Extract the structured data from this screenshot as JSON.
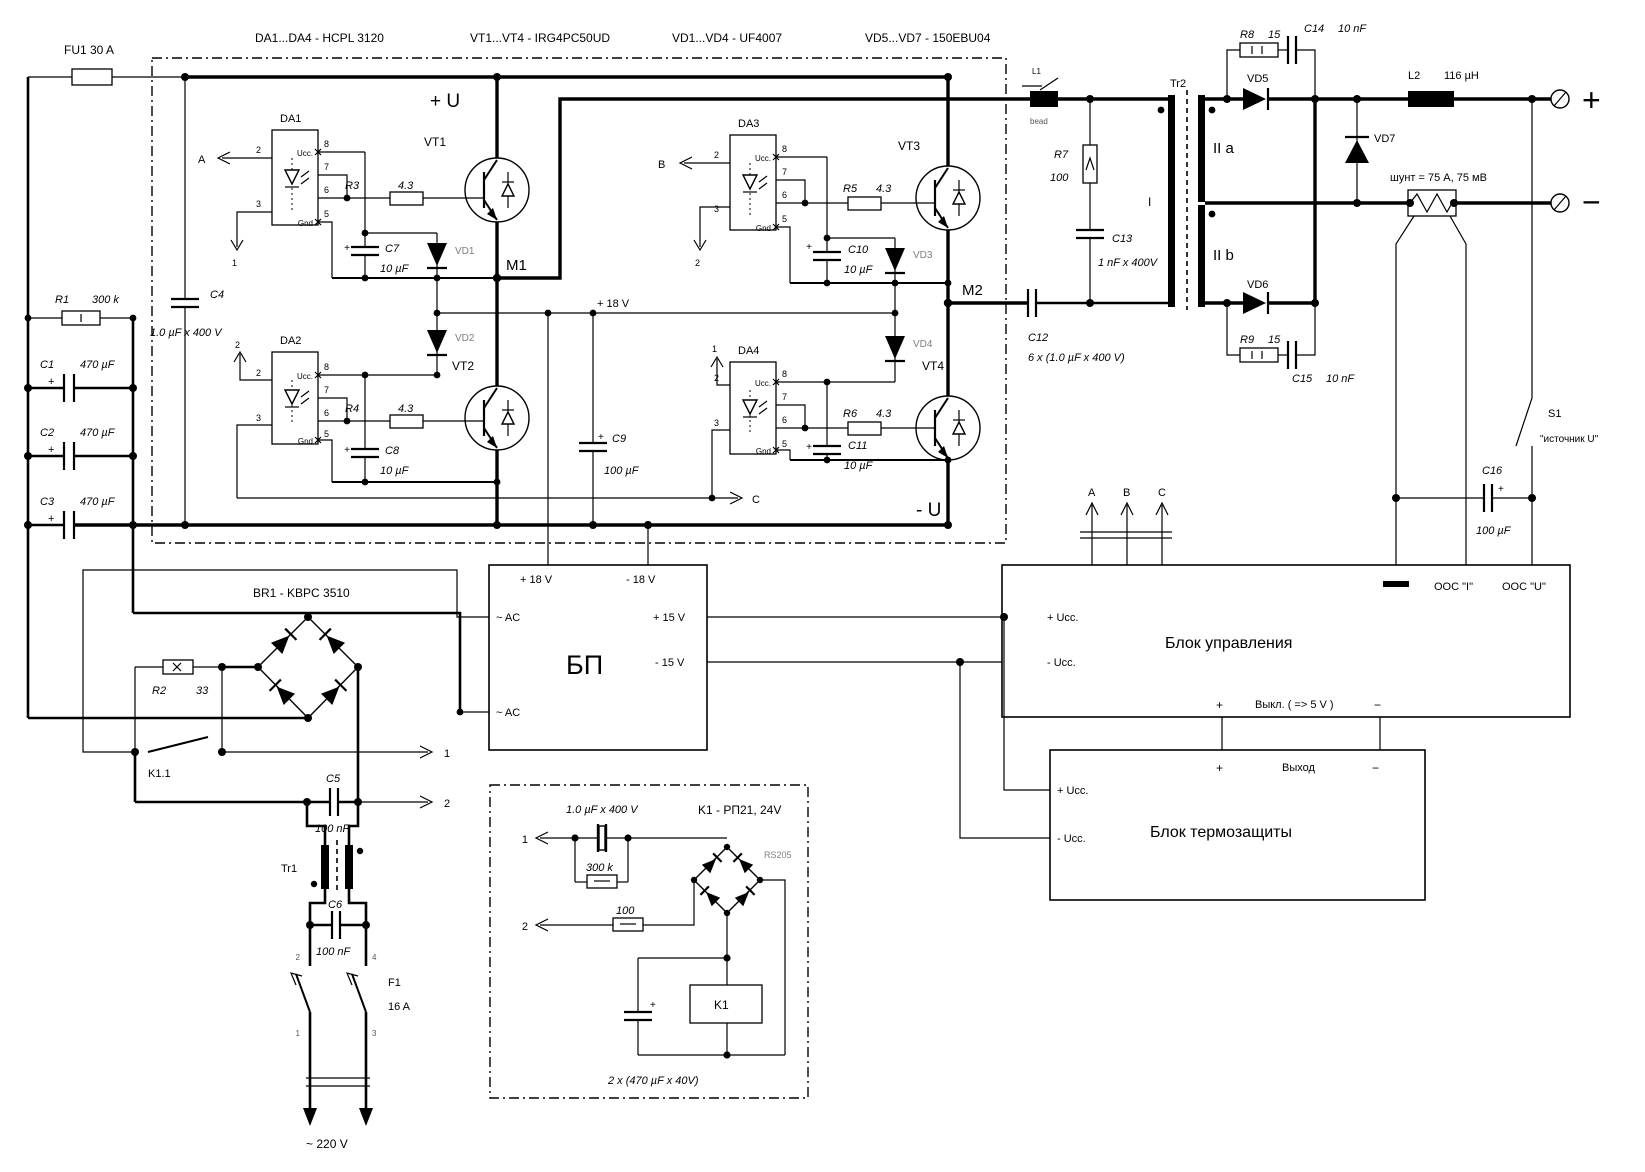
{
  "title_row": {
    "da": "DA1...DA4 -  HCPL 3120",
    "vt": "VT1...VT4 -  IRG4PC50UD",
    "vd14": "VD1...VD4  -  UF4007",
    "vd57": "VD5...VD7 -  150EBU04"
  },
  "sym": {
    "plus": "+",
    "minus": "−",
    "n1": "1",
    "n2": "2",
    "n3": "3",
    "n4": "4",
    "n5": "5",
    "n6": "6",
    "n7": "7",
    "n8": "8",
    "A": "A",
    "B": "B",
    "C": "C"
  },
  "input": {
    "fu1": "FU1    30 A",
    "r1": "R1",
    "r1v": "300 k",
    "c1": "C1",
    "c2": "C2",
    "c3": "C3",
    "cap470": "470 µF",
    "c4": "C4",
    "c4v": "1.0 µF x 400 V"
  },
  "inv": {
    "plusU": "+ U",
    "minusU": "- U",
    "m1": "M1",
    "m2": "M2",
    "p18": "+ 18 V",
    "c9": "C9",
    "uF100": "100 µF",
    "da1": "DA1",
    "da2": "DA2",
    "da3": "DA3",
    "da4": "DA4",
    "ucc": "Ucc.",
    "gnd": "Gnd",
    "r3": "R3",
    "r4": "R4",
    "r5": "R5",
    "r6": "R6",
    "r43": "4.3",
    "c7": "C7",
    "c8": "C8",
    "c10": "C10",
    "c11": "C11",
    "uF10": "10 µF",
    "vd1": "VD1",
    "vd2": "VD2",
    "vd3": "VD3",
    "vd4": "VD4",
    "vt1": "VT1",
    "vt2": "VT2",
    "vt3": "VT3",
    "vt4": "VT4"
  },
  "out": {
    "l1": "L1",
    "bead": "bead",
    "r7": "R7",
    "r7v": "100",
    "c13": "C13",
    "c13v": "1 nF x 400V",
    "c12": "C12",
    "c12v": "6 x (1.0 µF x 400 V)",
    "tr2": "Tr2",
    "wI": "I",
    "wIIa": "II a",
    "wIIb": "II b",
    "vd5": "VD5",
    "vd6": "VD6",
    "vd7": "VD7",
    "r8": "R8",
    "r9": "R9",
    "r15": "15",
    "c14": "C14",
    "c15": "C15",
    "nF10": "10 nF",
    "l2": "L2",
    "l2v": "116 µH",
    "shunt": "шунт = 75 A, 75 мВ",
    "s1": "S1",
    "s1v": "\"источник  U\"",
    "c16": "C16"
  },
  "blocks": {
    "ctrl": "Блок   управления",
    "therm": "Блок   термозащиты",
    "bp": "БП",
    "uccP": "+ Ucc.",
    "uccM": "- Ucc.",
    "oosI": "ООС \"I\"",
    "oosU": "ООС \"U\"",
    "vykl": "Выкл. ( => 5 V )",
    "vyhod": "Выход",
    "ac": "~ AC",
    "p15": "+ 15 V",
    "m15": "- 15 V",
    "p18": "+ 18 V",
    "m18": "- 18 V"
  },
  "mains": {
    "br1": "BR1 - KBPC 3510",
    "r2": "R2",
    "r2v": "33",
    "k11": "K1.1",
    "c5": "C5",
    "c6": "C6",
    "nF100": "100 nF",
    "tr1": "Tr1",
    "f1": "F1",
    "f1v": "16 A",
    "v220": "~  220 V"
  },
  "relay": {
    "k1t": "K1 - РП21, 24V",
    "capv": "1.0 µF x 400 V",
    "k300": "300 k",
    "r100": "100",
    "rs205": "RS205",
    "k1": "K1",
    "caps": "2 x (470 µF x 40V)"
  }
}
